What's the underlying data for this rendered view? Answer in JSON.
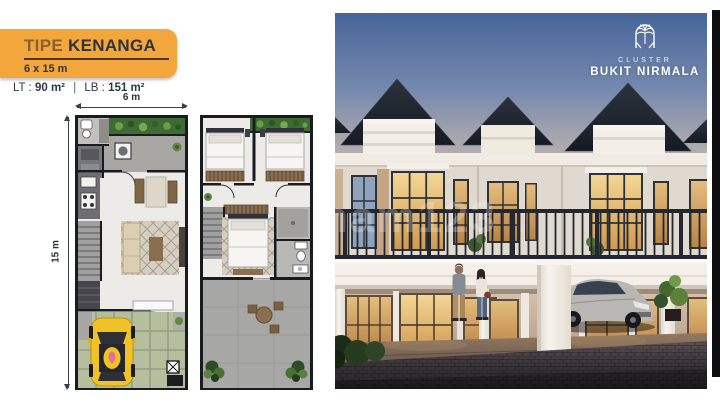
{
  "header": {
    "type_label": "TIPE",
    "type_name": "KENANGA",
    "dimensions": "6 x 15 m",
    "lt_label": "LT :",
    "lt_value": "90 m²",
    "separator": "|",
    "lb_label": "LB :",
    "lb_value": "151 m²"
  },
  "floorplans": {
    "width_label": "6 m",
    "height_label": "15 m"
  },
  "photo": {
    "cluster_label": "CLUSTER",
    "cluster_name": "BUKIT NIRMALA",
    "watermark": "nam123"
  },
  "colors": {
    "banner_orange": "#F2A63C",
    "banner_text": "#2F343B",
    "underline_brown": "#4A3428",
    "info_text": "#2C3A45",
    "plan_wall": "#181C22",
    "planter_green": "#3E6B31",
    "carport_green": "#B5BF9D",
    "car_yellow": "#F0C226",
    "sky_blue": "#4A679B",
    "roof_dark": "#20262F",
    "facade_white": "#F1EDE6",
    "window_glow": "#E2AE62",
    "pavement_dark": "#322C32",
    "black_bar": "#0E0E10"
  }
}
